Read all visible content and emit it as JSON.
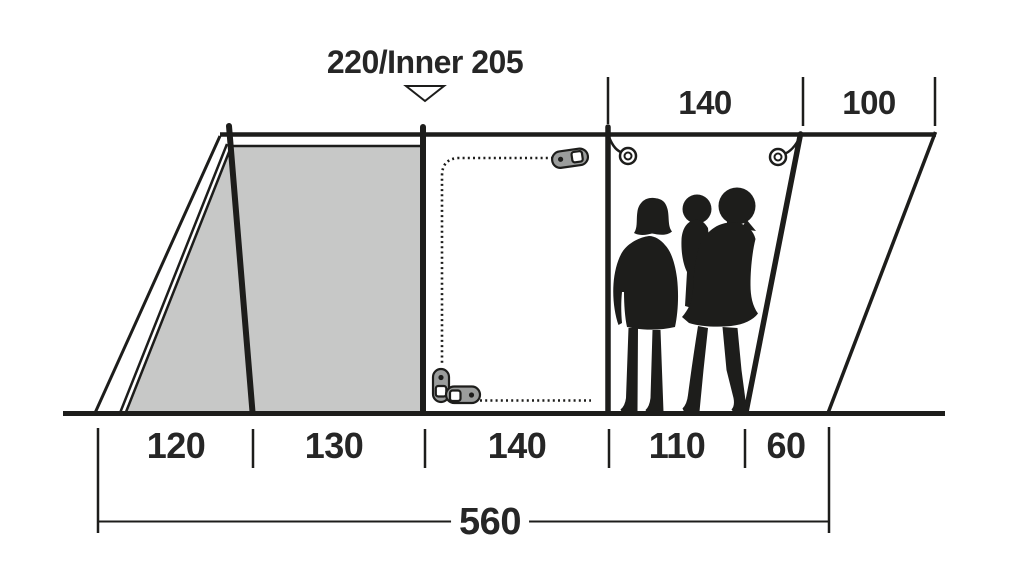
{
  "diagram": {
    "title": "220/Inner 205",
    "dimensions_top": [
      {
        "label": "140"
      },
      {
        "label": "100"
      }
    ],
    "dimensions_bottom": [
      {
        "label": "120"
      },
      {
        "label": "130"
      },
      {
        "label": "140"
      },
      {
        "label": "110"
      },
      {
        "label": "60"
      }
    ],
    "dimension_total": {
      "label": "560"
    },
    "colors": {
      "line": "#1d1d1b",
      "inner_tent_fill": "#c7c8c7",
      "zipper_fill": "#9b9d9c",
      "background": "#ffffff",
      "text": "#262626"
    }
  }
}
